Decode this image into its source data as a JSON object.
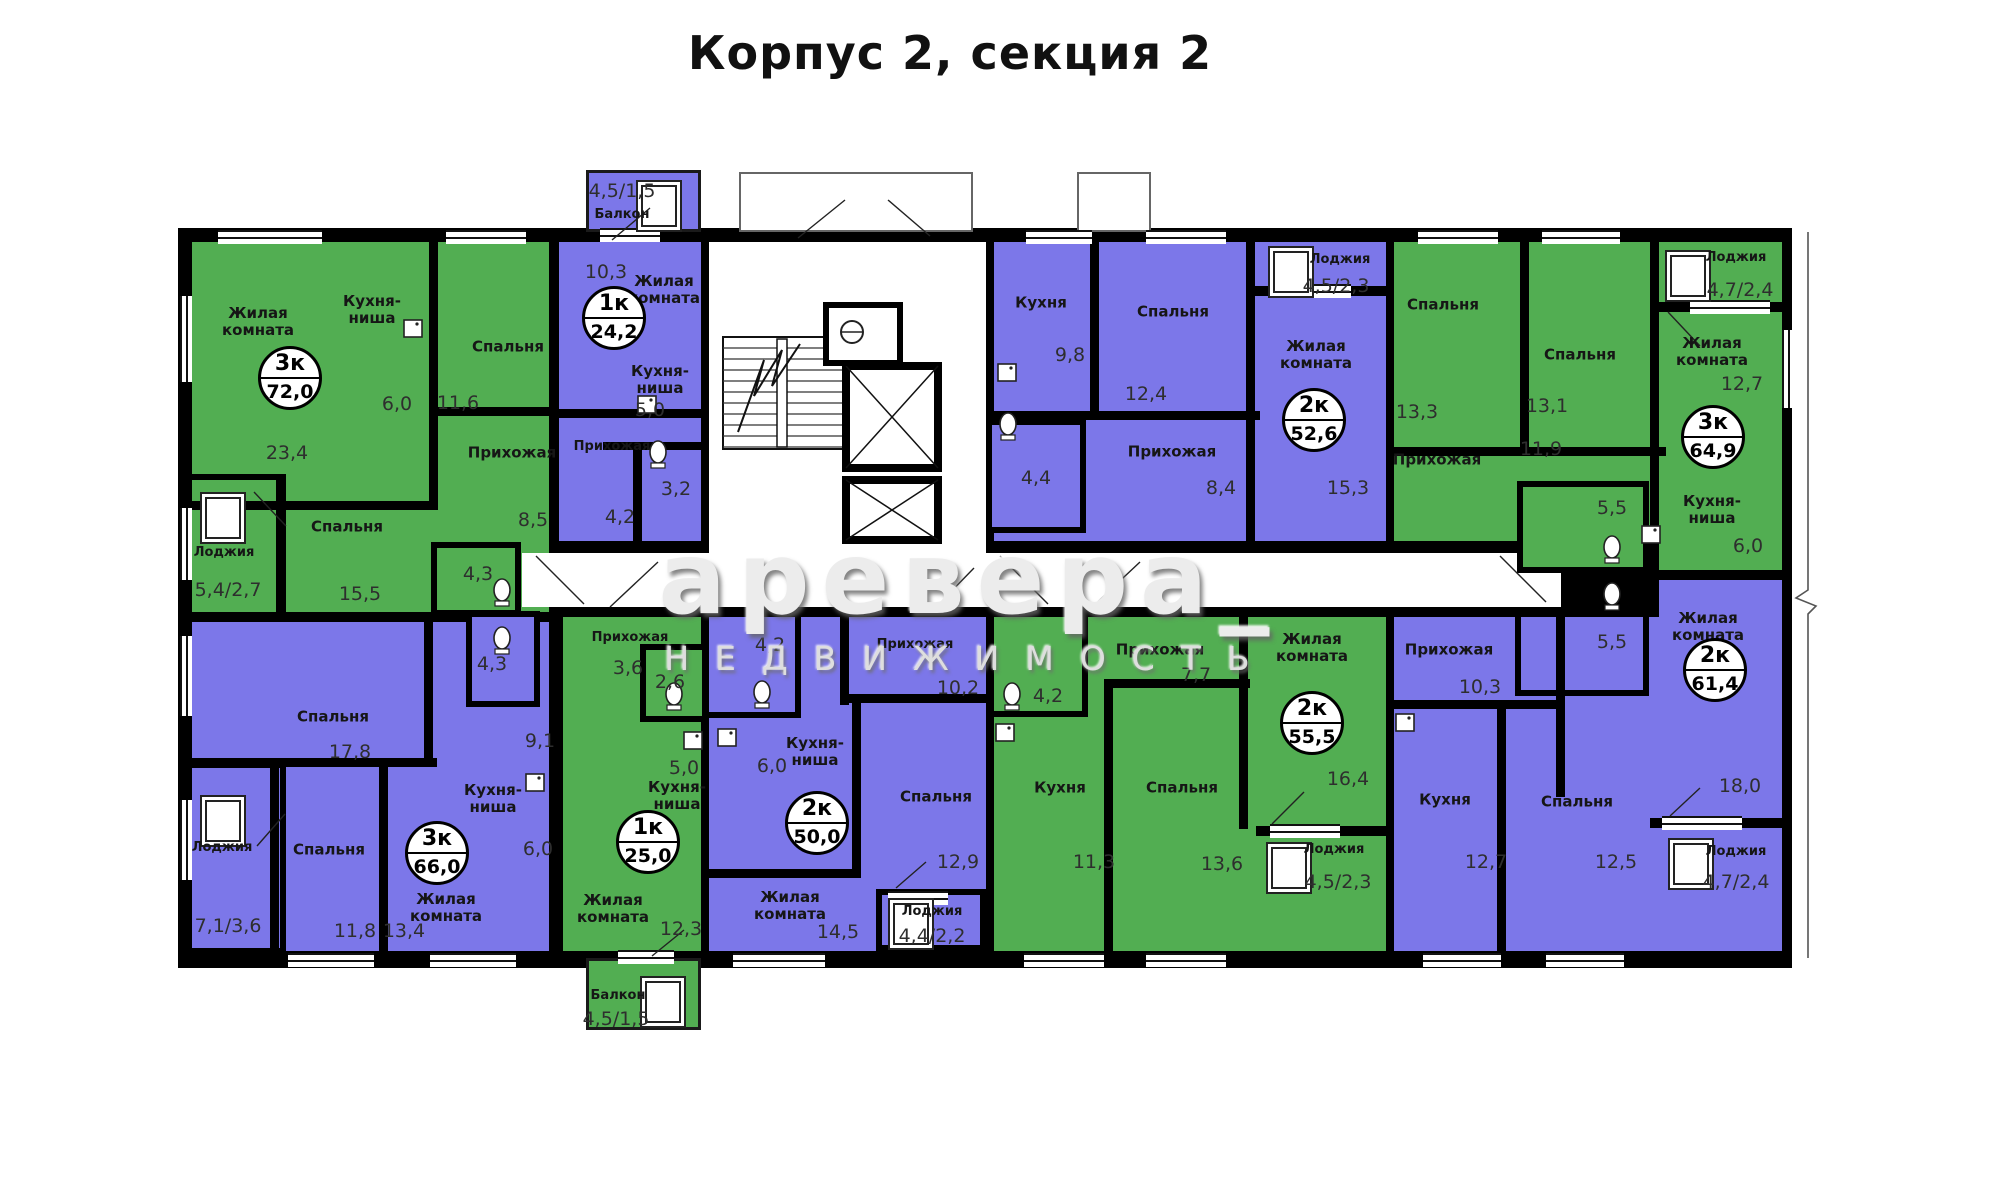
{
  "title": "Корпус 2, секция 2",
  "watermark": {
    "line1": "аревера_",
    "line2": "НЕДВИЖИМОСТЬ"
  },
  "colors": {
    "green": "#52ae52",
    "purple": "#7c77e9",
    "wall": "#000000",
    "corridor": "#ffffff"
  },
  "apartments": [
    {
      "id": "apt-3k-72",
      "type": "3к",
      "total_area": "72,0",
      "color": "green",
      "badge": {
        "x": 290,
        "y": 378
      },
      "rooms": [
        {
          "label": "Жилая\nкомната",
          "area": "23,4",
          "lx": 258,
          "ly": 322,
          "ax": 287,
          "ay": 453
        },
        {
          "label": "Кухня-\nниша",
          "area": "6,0",
          "lx": 372,
          "ly": 310,
          "ax": 397,
          "ay": 404
        },
        {
          "label": "Спальня",
          "area": "11,6",
          "lx": 508,
          "ly": 347,
          "ax": 458,
          "ay": 403
        },
        {
          "label": "Прихожая",
          "area": "8,5",
          "lx": 512,
          "ly": 453,
          "ax": 533,
          "ay": 520
        },
        {
          "label": "Спальня",
          "area": "15,5",
          "lx": 347,
          "ly": 527,
          "ax": 360,
          "ay": 594
        },
        {
          "label": null,
          "area": "4,3",
          "ax": 478,
          "ay": 574
        },
        {
          "label": "Лоджия",
          "area": "5,4/2,7",
          "lx": 224,
          "ly": 553,
          "ax": 228,
          "ay": 590,
          "small": true
        }
      ]
    },
    {
      "id": "apt-1k-24",
      "type": "1к",
      "total_area": "24,2",
      "color": "purple",
      "badge": {
        "x": 614,
        "y": 318
      },
      "rooms": [
        {
          "label": "Балкон",
          "area": "4,5/1,5",
          "lx": 622,
          "ly": 215,
          "ax": 622,
          "ay": 191,
          "small": true
        },
        {
          "label": "Жилая\nкомната",
          "area": "10,3",
          "lx": 664,
          "ly": 290,
          "ax": 606,
          "ay": 272
        },
        {
          "label": "Кухня-\nниша",
          "area": "5,0",
          "lx": 660,
          "ly": 380,
          "ax": 650,
          "ay": 410
        },
        {
          "label": "Прихожая",
          "area": "4,2",
          "lx": 612,
          "ly": 447,
          "ax": 620,
          "ay": 517,
          "small": true
        },
        {
          "label": null,
          "area": "3,2",
          "ax": 676,
          "ay": 489
        }
      ]
    },
    {
      "id": "apt-2k-52",
      "type": "2к",
      "total_area": "52,6",
      "color": "purple",
      "badge": {
        "x": 1314,
        "y": 420
      },
      "rooms": [
        {
          "label": "Кухня",
          "area": "9,8",
          "lx": 1041,
          "ly": 303,
          "ax": 1070,
          "ay": 355
        },
        {
          "label": "Спальня",
          "area": "12,4",
          "lx": 1173,
          "ly": 312,
          "ax": 1146,
          "ay": 394
        },
        {
          "label": "Жилая\nкомната",
          "area": "15,3",
          "lx": 1316,
          "ly": 355,
          "ax": 1348,
          "ay": 488
        },
        {
          "label": "Прихожая",
          "area": "8,4",
          "lx": 1172,
          "ly": 452,
          "ax": 1221,
          "ay": 488
        },
        {
          "label": null,
          "area": "4,4",
          "ax": 1036,
          "ay": 478
        },
        {
          "label": "Лоджия",
          "area": "4,5/2,3",
          "lx": 1340,
          "ly": 260,
          "ax": 1336,
          "ay": 286,
          "small": true
        }
      ]
    },
    {
      "id": "apt-3k-64",
      "type": "3к",
      "total_area": "64,9",
      "color": "green",
      "badge": {
        "x": 1713,
        "y": 437
      },
      "rooms": [
        {
          "label": "Спальня",
          "area": "13,3",
          "lx": 1443,
          "ly": 305,
          "ax": 1417,
          "ay": 412
        },
        {
          "label": "Спальня",
          "area": "13,1",
          "lx": 1580,
          "ly": 355,
          "ax": 1547,
          "ay": 406
        },
        {
          "label": "Жилая\nкомната",
          "area": "12,7",
          "lx": 1712,
          "ly": 352,
          "ax": 1742,
          "ay": 384
        },
        {
          "label": "Прихожая",
          "area": "11,9",
          "lx": 1437,
          "ly": 460,
          "ax": 1541,
          "ay": 449
        },
        {
          "label": null,
          "area": "5,5",
          "ax": 1612,
          "ay": 508
        },
        {
          "label": "Кухня-\nниша",
          "area": "6,0",
          "lx": 1712,
          "ly": 510,
          "ax": 1748,
          "ay": 546
        },
        {
          "label": "Лоджия",
          "area": "4,7/2,4",
          "lx": 1736,
          "ly": 258,
          "ax": 1740,
          "ay": 290,
          "small": true
        }
      ]
    },
    {
      "id": "apt-2k-61",
      "type": "2к",
      "total_area": "61,4",
      "color": "purple",
      "badge": {
        "x": 1715,
        "y": 670
      },
      "rooms": [
        {
          "label": "Прихожая",
          "area": "10,3",
          "lx": 1449,
          "ly": 650,
          "ax": 1480,
          "ay": 687
        },
        {
          "label": null,
          "area": "5,5",
          "ax": 1612,
          "ay": 642
        },
        {
          "label": "Жилая\nкомната",
          "area": "18,0",
          "lx": 1708,
          "ly": 627,
          "ax": 1740,
          "ay": 786
        },
        {
          "label": "Кухня",
          "area": "12,7",
          "lx": 1445,
          "ly": 800,
          "ax": 1486,
          "ay": 862
        },
        {
          "label": "Спальня",
          "area": "12,5",
          "lx": 1577,
          "ly": 802,
          "ax": 1616,
          "ay": 862
        },
        {
          "label": "Лоджия",
          "area": "4,7/2,4",
          "lx": 1736,
          "ly": 852,
          "ax": 1736,
          "ay": 882,
          "small": true
        }
      ]
    },
    {
      "id": "apt-2k-55",
      "type": "2к",
      "total_area": "55,5",
      "color": "green",
      "badge": {
        "x": 1312,
        "y": 723
      },
      "rooms": [
        {
          "label": "Прихожая",
          "area": "7,7",
          "lx": 1160,
          "ly": 650,
          "ax": 1196,
          "ay": 675
        },
        {
          "label": null,
          "area": "4,2",
          "ax": 1048,
          "ay": 696
        },
        {
          "label": "Кухня",
          "area": "11,3",
          "lx": 1060,
          "ly": 788,
          "ax": 1094,
          "ay": 862
        },
        {
          "label": "Спальня",
          "area": "13,6",
          "lx": 1182,
          "ly": 788,
          "ax": 1222,
          "ay": 864
        },
        {
          "label": "Жилая\nкомната",
          "area": "16,4",
          "lx": 1312,
          "ly": 648,
          "ax": 1348,
          "ay": 779
        },
        {
          "label": "Лоджия",
          "area": "4,5/2,3",
          "lx": 1334,
          "ly": 850,
          "ax": 1338,
          "ay": 882,
          "small": true
        }
      ]
    },
    {
      "id": "apt-2k-50",
      "type": "2к",
      "total_area": "50,0",
      "color": "purple",
      "badge": {
        "x": 817,
        "y": 823
      },
      "rooms": [
        {
          "label": null,
          "area": "4,2",
          "ax": 770,
          "ay": 645
        },
        {
          "label": "Прихожая",
          "area": "10,2",
          "lx": 915,
          "ly": 645,
          "ax": 958,
          "ay": 688,
          "small": true
        },
        {
          "label": "Кухня-\nниша",
          "area": "6,0",
          "lx": 815,
          "ly": 752,
          "ax": 772,
          "ay": 766
        },
        {
          "label": "Спальня",
          "area": "12,9",
          "lx": 936,
          "ly": 797,
          "ax": 958,
          "ay": 862
        },
        {
          "label": "Жилая\nкомната",
          "area": "14,5",
          "lx": 790,
          "ly": 906,
          "ax": 838,
          "ay": 932
        },
        {
          "label": "Лоджия",
          "area": "4,4/2,2",
          "lx": 932,
          "ly": 912,
          "ax": 932,
          "ay": 936,
          "small": true
        }
      ]
    },
    {
      "id": "apt-1k-25",
      "type": "1к",
      "total_area": "25,0",
      "color": "green",
      "badge": {
        "x": 648,
        "y": 842
      },
      "rooms": [
        {
          "label": "Прихожая",
          "area": "3,6",
          "lx": 630,
          "ly": 638,
          "ax": 628,
          "ay": 668,
          "small": true
        },
        {
          "label": null,
          "area": "2,6",
          "ax": 670,
          "ay": 682
        },
        {
          "label": "Кухня-\nниша",
          "area": "5,0",
          "lx": 677,
          "ly": 796,
          "ax": 684,
          "ay": 768
        },
        {
          "label": "Жилая\nкомната",
          "area": "12,3",
          "lx": 613,
          "ly": 909,
          "ax": 681,
          "ay": 929
        },
        {
          "label": "Балкон",
          "area": "4,5/1,5",
          "lx": 618,
          "ly": 996,
          "ax": 616,
          "ay": 1019,
          "small": true
        }
      ]
    },
    {
      "id": "apt-3k-66",
      "type": "3к",
      "total_area": "66,0",
      "color": "purple",
      "badge": {
        "x": 437,
        "y": 853
      },
      "rooms": [
        {
          "label": "Спальня",
          "area": "17,8",
          "lx": 333,
          "ly": 717,
          "ax": 350,
          "ay": 752
        },
        {
          "label": null,
          "area": "4,3",
          "ax": 492,
          "ay": 664
        },
        {
          "label": null,
          "area": "9,1",
          "ax": 540,
          "ay": 741
        },
        {
          "label": "Кухня-\nниша",
          "area": "6,0",
          "lx": 493,
          "ly": 799,
          "ax": 538,
          "ay": 849
        },
        {
          "label": "Спальня",
          "area": "11,8",
          "lx": 329,
          "ly": 850,
          "ax": 355,
          "ay": 931
        },
        {
          "label": "Жилая\nкомната",
          "area": "13,4",
          "lx": 446,
          "ly": 908,
          "ax": 404,
          "ay": 931
        },
        {
          "label": "Лоджия",
          "area": "7,1/3,6",
          "lx": 222,
          "ly": 848,
          "ax": 228,
          "ay": 926,
          "small": true
        }
      ]
    }
  ]
}
